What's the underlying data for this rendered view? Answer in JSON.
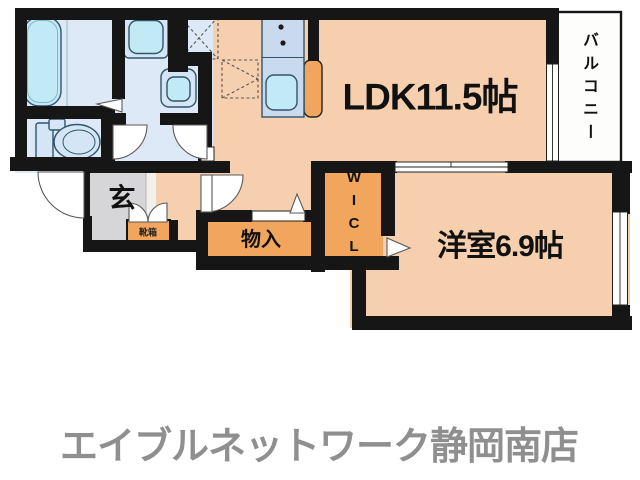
{
  "floorplan": {
    "rooms": {
      "ldk": "LDK11.5帖",
      "bedroom": "洋室6.9帖",
      "balcony": "バルコニー",
      "walk_in_closet": "WICL",
      "storage": "物入",
      "entrance": "玄",
      "shoe_cabinet": "靴箱"
    },
    "footer": "エイブルネットワーク静岡南店",
    "colors": {
      "floor": "#f6d0ae",
      "closet": "#f2a55c",
      "wet": "#dde9f6",
      "fixture": "#d4e6f5",
      "tub": "#c2eaf6",
      "counter": "#c9daee",
      "wall": "#161616",
      "genkan": "#d6d6d8",
      "landing": "#f2f0ec",
      "balcony_bg": "#fdfdfb",
      "footer_text": "#8f8f8f"
    }
  }
}
